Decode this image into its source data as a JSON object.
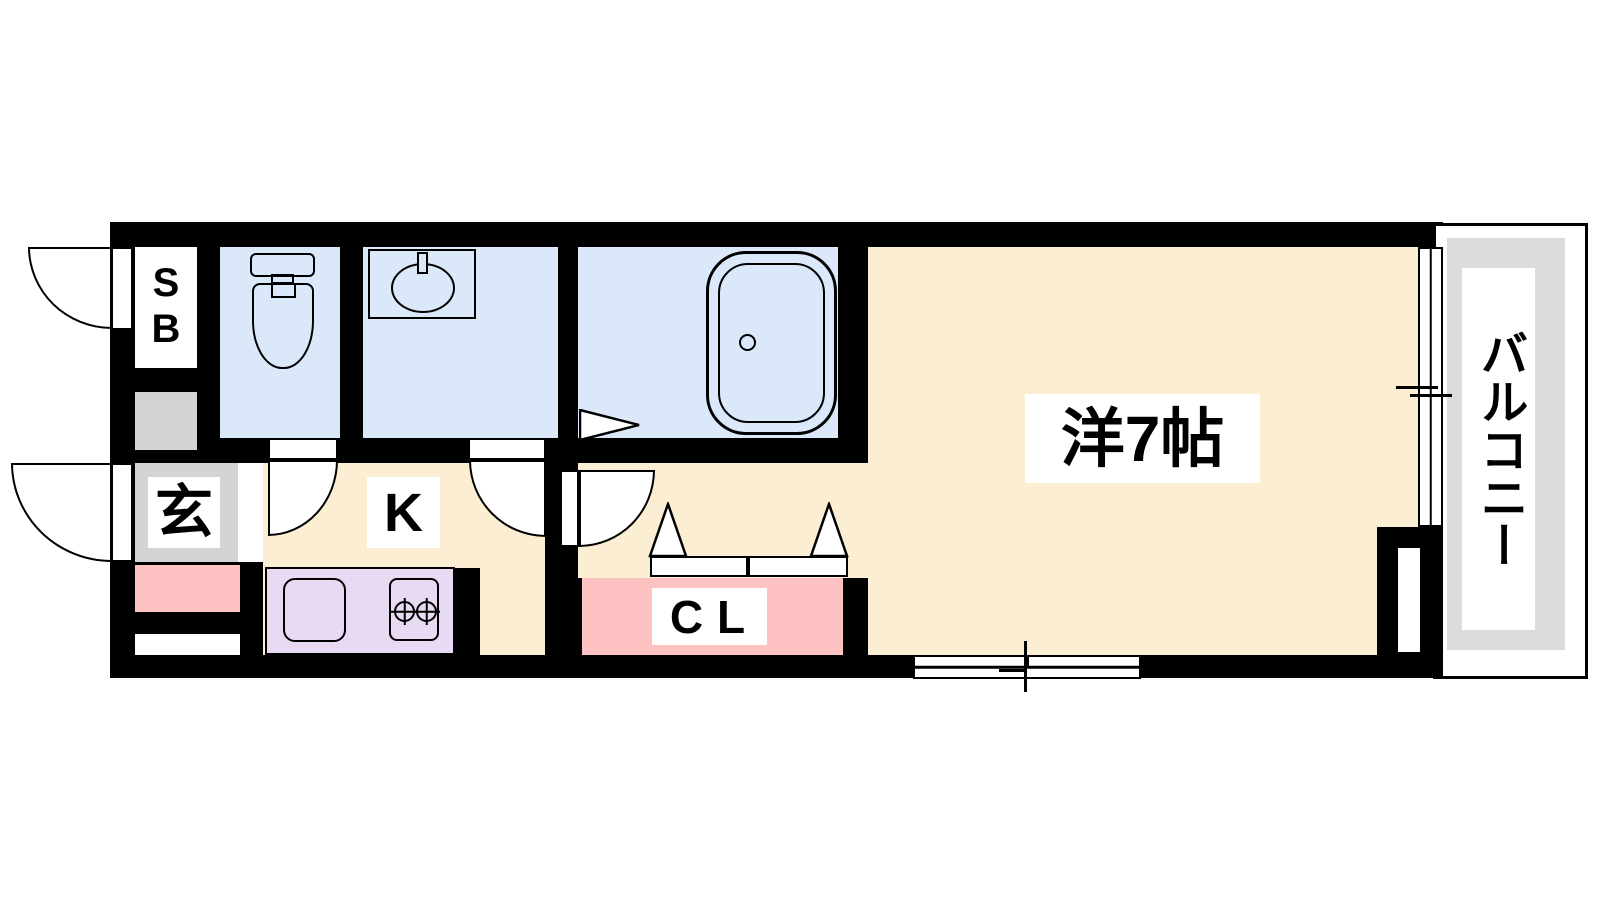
{
  "plan": {
    "type": "apartment-floor-plan",
    "rooms": {
      "shoe_box": {
        "label": "SB"
      },
      "entrance": {
        "label": "玄"
      },
      "kitchen": {
        "label": "K"
      },
      "closet": {
        "label": "CL"
      },
      "main_room": {
        "label": "洋7帖"
      },
      "balcony": {
        "label": "バルコニー"
      }
    },
    "fixtures": [
      "toilet",
      "washbasin",
      "bathtub",
      "kitchen-sink",
      "two-burner-stove",
      "hinged-doors",
      "folding-doors",
      "sliding-windows"
    ],
    "colors": {
      "floor_cream": "#FBEED3",
      "wet_area_blue": "#DBE8FA",
      "closet_pink": "#FFC2C2",
      "kitchen_counter_purple": "#E7DAF2",
      "entrance_gray": "#D4D4D4",
      "balcony_gray": "#DBDBDB",
      "wall_black": "#000000",
      "background_white": "#FFFFFF"
    }
  }
}
